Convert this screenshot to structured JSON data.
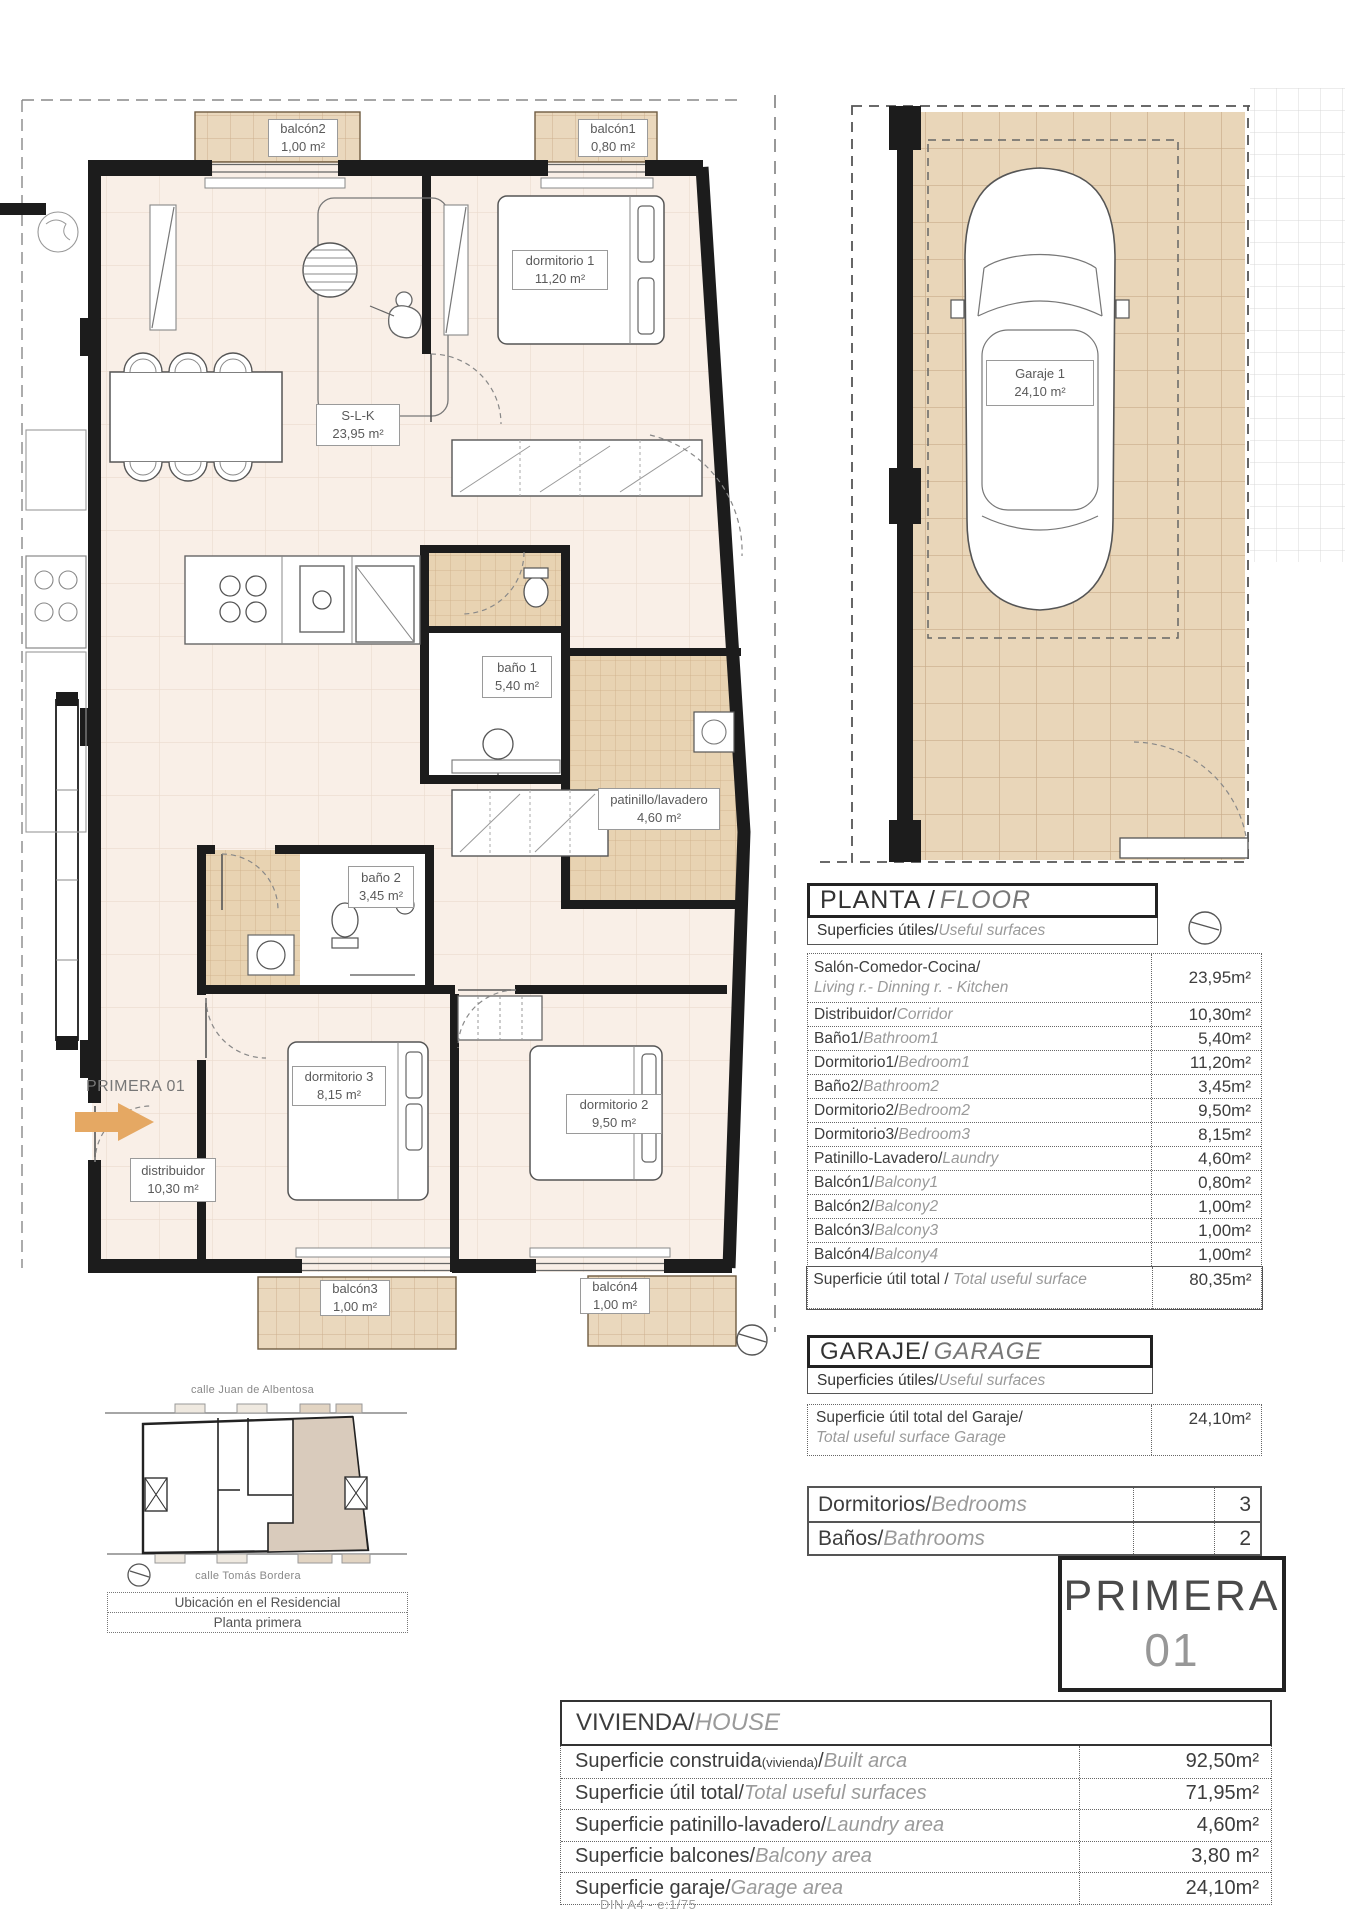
{
  "plan": {
    "entry_label": "PRIMERA 01",
    "labels": {
      "balcon2": {
        "name": "balcón2",
        "area": "1,00 m²"
      },
      "balcon1": {
        "name": "balcón1",
        "area": "0,80 m²"
      },
      "dormitorio1": {
        "name": "dormitorio 1",
        "area": "11,20 m²"
      },
      "slk": {
        "name": "S-L-K",
        "area": "23,95 m²"
      },
      "bano1": {
        "name": "baño 1",
        "area": "5,40 m²"
      },
      "patinillo": {
        "name": "patinillo/lavadero",
        "area": "4,60 m²"
      },
      "bano2": {
        "name": "baño 2",
        "area": "3,45 m²"
      },
      "dormitorio3": {
        "name": "dormitorio 3",
        "area": "8,15 m²"
      },
      "dormitorio2": {
        "name": "dormitorio 2",
        "area": "9,50 m²"
      },
      "distribuidor": {
        "name": "distribuidor",
        "area": "10,30 m²"
      },
      "balcon3": {
        "name": "balcón3",
        "area": "1,00 m²"
      },
      "balcon4": {
        "name": "balcón4",
        "area": "1,00 m²"
      }
    }
  },
  "garage_plan": {
    "label": {
      "name": "Garaje 1",
      "area": "24,10 m²"
    }
  },
  "planta": {
    "title_es": "PLANTA / ",
    "title_en": "FLOOR",
    "subtitle_es": "Superficies útiles/",
    "subtitle_en": "Useful surfaces",
    "rows": [
      {
        "es": "Salón-Comedor-Cocina/",
        "en": "Living r.- Dinning r. - Kitchen",
        "value": "23,95m²"
      },
      {
        "es": "Distribuidor/",
        "en": "Corridor",
        "value": "10,30m²"
      },
      {
        "es": "Baño1/",
        "en": "Bathroom1",
        "value": "5,40m²"
      },
      {
        "es": "Dormitorio1/",
        "en": "Bedroom1",
        "value": "11,20m²"
      },
      {
        "es": "Baño2/",
        "en": "Bathroom2",
        "value": "3,45m²"
      },
      {
        "es": "Dormitorio2/",
        "en": "Bedroom2",
        "value": "9,50m²"
      },
      {
        "es": "Dormitorio3/",
        "en": "Bedroom3",
        "value": "8,15m²"
      },
      {
        "es": "Patinillo-Lavadero/",
        "en": "Laundry",
        "value": "4,60m²"
      },
      {
        "es": "Balcón1/",
        "en": "Balcony1",
        "value": "0,80m²"
      },
      {
        "es": "Balcón2/",
        "en": "Balcony2",
        "value": "1,00m²"
      },
      {
        "es": "Balcón3/",
        "en": "Balcony3",
        "value": "1,00m²"
      },
      {
        "es": "Balcón4/",
        "en": "Balcony4",
        "value": "1,00m²"
      },
      {
        "es": "Superficie útil total / ",
        "en": "Total useful surface",
        "value": "80,35m²"
      }
    ]
  },
  "garaje": {
    "title_es": "GARAJE/",
    "title_en": "GARAGE",
    "subtitle_es": "Superficies útiles/",
    "subtitle_en": "Useful surfaces",
    "total_es": "Superficie útil total del Garaje/",
    "total_en": "Total useful surface Garage",
    "total_value": "24,10m²"
  },
  "counts": {
    "rows": [
      {
        "es": "Dormitorios/",
        "en": "Bedrooms",
        "value": "3"
      },
      {
        "es": "Baños/",
        "en": "Bathrooms",
        "value": "2"
      }
    ]
  },
  "unit_badge": {
    "line1": "PRIMERA",
    "line2": "01"
  },
  "vivienda": {
    "title_es": "VIVIENDA/",
    "title_en": "HOUSE",
    "rows": [
      {
        "es": "Superficie construida",
        "small": "(vivienda)",
        "sep": "/",
        "en": "Built arca",
        "value": "92,50m²"
      },
      {
        "es": "Superficie útil total/",
        "en": "Total useful surfaces",
        "value": "71,95m²"
      },
      {
        "es": "Superficie patinillo-lavadero/",
        "en": "Laundry area",
        "value": "4,60m²"
      },
      {
        "es": "Superficie balcones/",
        "en": "Balcony area",
        "value": "3,80 m²"
      },
      {
        "es": "Superficie garaje/",
        "en": "Garage area",
        "value": "24,10m²"
      }
    ]
  },
  "site": {
    "street_top": "calle Juan de Albentosa",
    "street_bottom": "calle Tomás Bordera",
    "caption_line1": "Ubicación en el Residencial",
    "caption_line2": "Planta primera"
  },
  "footer": "DIN A4 - e:1/75",
  "colors": {
    "tile": "#ead8bd",
    "tile_line": "#cdb08e",
    "floor": "#f9efe7",
    "floor_line": "#eadbce",
    "wall": "#1c1c1c",
    "accent_arrow": "#e5a863",
    "shaded_unit": "#d9cbbc"
  }
}
